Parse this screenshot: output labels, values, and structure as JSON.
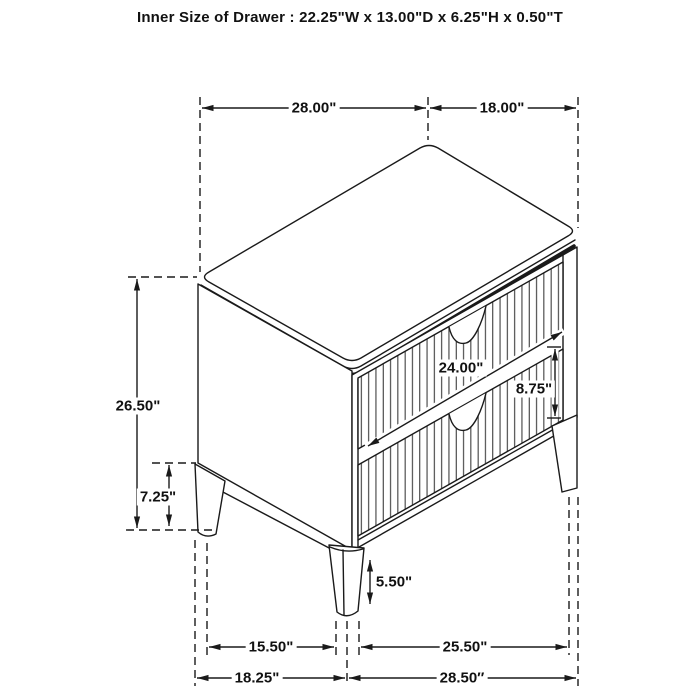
{
  "title": "Inner Size of Drawer : 22.25\"W x 13.00\"D x 6.25\"H x 0.50\"T",
  "dimensions": {
    "top_width": "28.00\"",
    "top_depth": "18.00\"",
    "overall_height": "26.50\"",
    "side_leg_height": "7.25\"",
    "drawer_width": "24.00\"",
    "drawer_front_height": "8.75\"",
    "front_leg_height": "5.50\"",
    "front_leg_spacing": "15.50\"",
    "side_leg_spacing": "25.50\"",
    "base_width": "18.25\"",
    "base_depth": "28.50″"
  },
  "colors": {
    "line": "#1a1a1a",
    "background": "#ffffff"
  }
}
